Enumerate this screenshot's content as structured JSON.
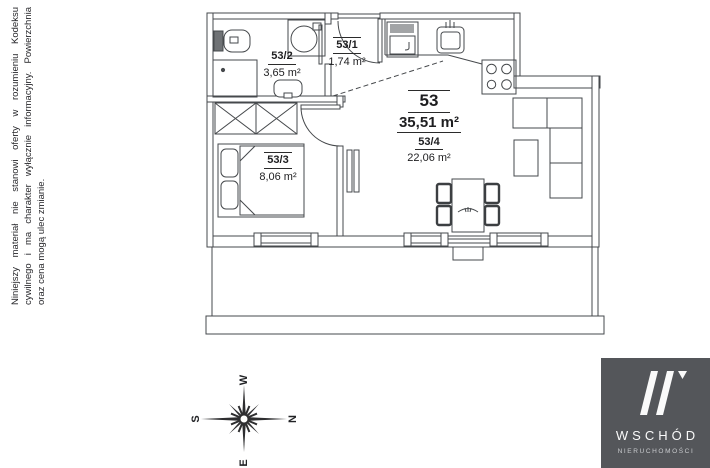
{
  "disclaimer": {
    "line1": "Niniejszy materiał nie stanowi oferty w rozumieniu Kodeksu",
    "line2": "cywilnego i ma charakter wyłącznie informacyjny. Powierzchnia",
    "line3": "oraz cena mogą ulec zmianie."
  },
  "plan": {
    "unit": {
      "number": "53",
      "area": "35,51 m²"
    },
    "rooms": [
      {
        "id": "53/2",
        "area": "3,65 m²"
      },
      {
        "id": "53/1",
        "area": "1,74 m²"
      },
      {
        "id": "53/3",
        "area": "8,06 m²"
      },
      {
        "id": "53/4",
        "area": "22,06 m²"
      }
    ]
  },
  "compass": {
    "north": "N",
    "south": "S",
    "east": "E",
    "west": "W"
  },
  "logo": {
    "name": "WSCHÓD",
    "subtitle": "NIERUCHOMOŚCI"
  },
  "colors": {
    "line": "#46494c",
    "logo_bg": "#54565a"
  }
}
